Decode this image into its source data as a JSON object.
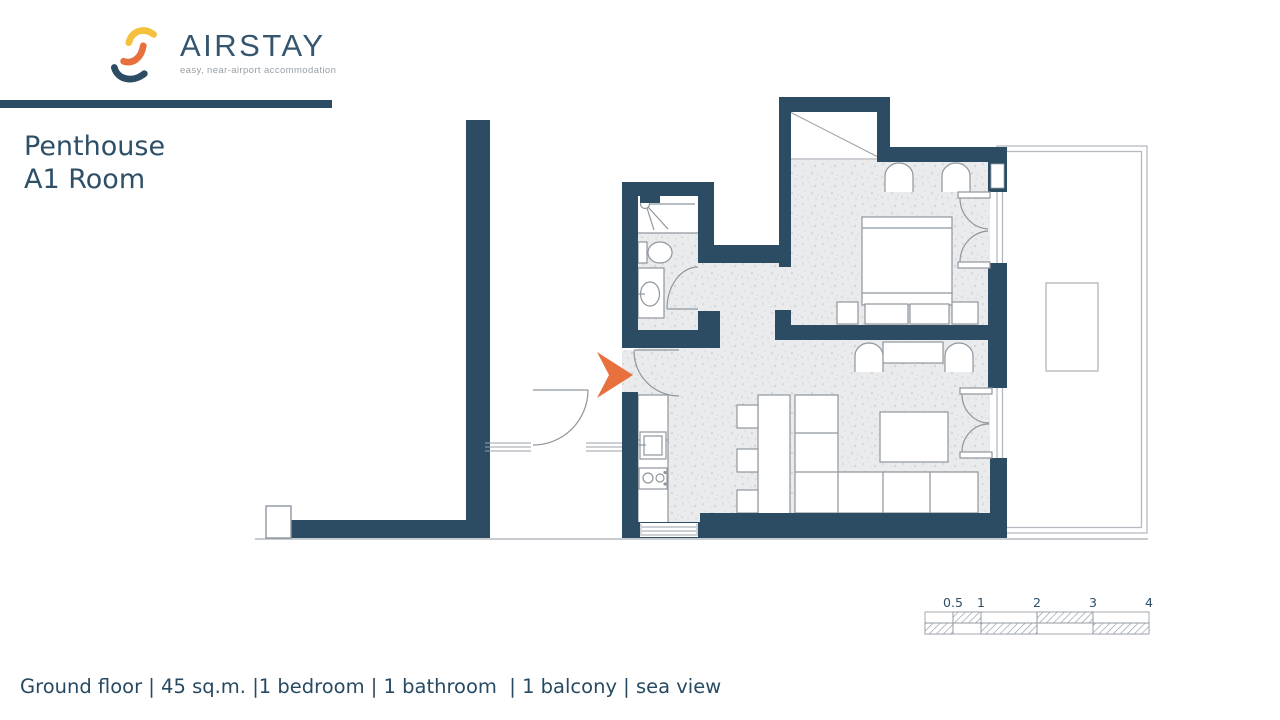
{
  "brand": {
    "name": "AIRSTAY",
    "tagline": "easy, near-airport accommodation"
  },
  "title": {
    "line1": "Penthouse",
    "line2": "A1 Room"
  },
  "scale_bar": {
    "labels": [
      "0.5",
      "1",
      "2",
      "3",
      "4"
    ]
  },
  "footer": {
    "caption": "Ground floor | 45 sq.m. |1 bedroom | 1 bathroom  | 1 balcony | sea view"
  },
  "colors": {
    "wall_navy": "#2c4c63",
    "accent_orange": "#e8703c",
    "logo_yellow": "#f4c13d",
    "text_navy": "#2e4f68",
    "tagline_gray": "#98a0a6",
    "floor_base": "#eaebec",
    "outline_gray": "#8f969e"
  }
}
